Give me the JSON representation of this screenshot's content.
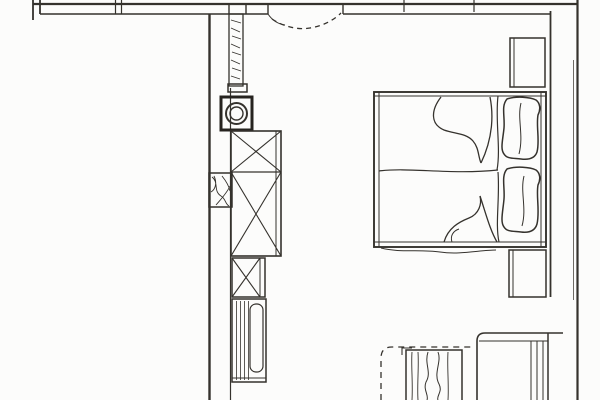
{
  "meta": {
    "title": "Scanned bedroom floor plan",
    "drawing_type": "architectural floor plan, hand-drafted scan",
    "contains_text": false
  },
  "colors": {
    "paper": "#fcfcfb",
    "ink": "#35322d",
    "ink_dark": "#26231f",
    "ink_light": "#6e6a64"
  },
  "plan": {
    "walls": [
      {
        "id": "top-wall",
        "label": "exterior wall (top), double line with joint ticks"
      },
      {
        "id": "left-wall",
        "label": "exterior wall (left), runs to bottom edge"
      },
      {
        "id": "right-wall",
        "label": "exterior wall (right), runs to bottom edge"
      },
      {
        "id": "wall-duct-band",
        "label": "thickened wall band behind bed headboard"
      },
      {
        "id": "partition-wall",
        "label": "hatched partition stub below top wall"
      },
      {
        "id": "masonry-pier",
        "label": "hatched pier block in left wall"
      }
    ],
    "openings": [
      {
        "id": "entry-door",
        "label": "door opening in top wall with dashed swing arc"
      }
    ],
    "furniture": [
      {
        "id": "circular-fixture",
        "label": "square fixture with double circle (basin/column)"
      },
      {
        "id": "wardrobe",
        "label": "wardrobe, two X-marked sections"
      },
      {
        "id": "cabinet-x",
        "label": "small X-marked cabinet"
      },
      {
        "id": "shelf-unit",
        "label": "striped unit with elongated rounded element"
      },
      {
        "id": "double-bed",
        "label": "double bed, two mattresses, two pillows, duvet folds"
      },
      {
        "id": "nightstand-top",
        "label": "bedside cabinet above bed"
      },
      {
        "id": "nightstand-bottom",
        "label": "bedside cabinet below bed"
      },
      {
        "id": "desk",
        "label": "desk / sideboard at bottom right"
      },
      {
        "id": "radiator",
        "label": "wavy-lined unit at bottom (radiator/bench)"
      },
      {
        "id": "hidden-outline",
        "label": "dashed hidden-edge corner at bottom"
      }
    ]
  }
}
